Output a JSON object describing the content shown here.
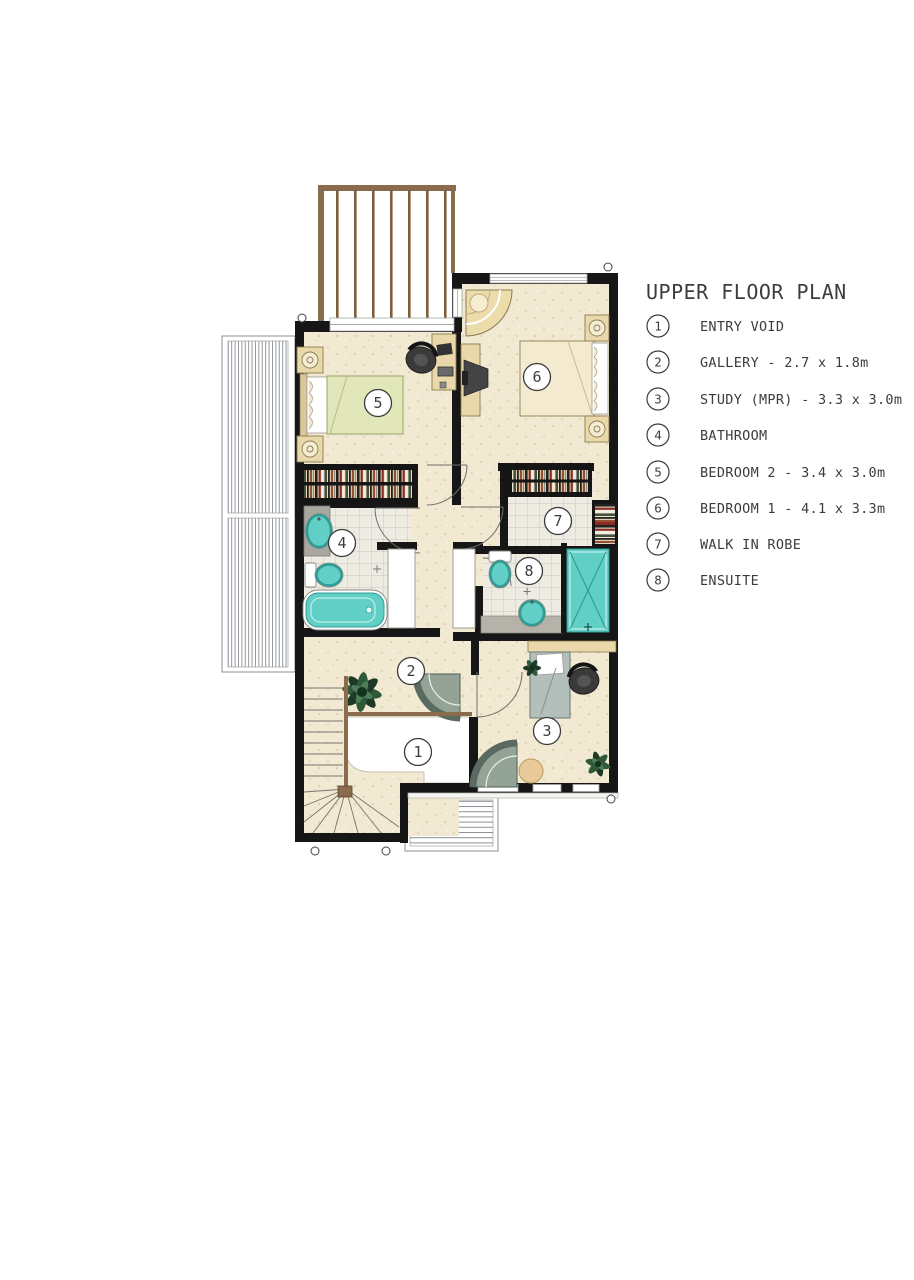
{
  "title": "UPPER FLOOR PLAN",
  "legend": {
    "items": [
      {
        "number": "1",
        "label": "ENTRY VOID"
      },
      {
        "number": "2",
        "label": "GALLERY - 2.7 x 1.8m"
      },
      {
        "number": "3",
        "label": "STUDY (MPR) - 3.3 x 3.0m"
      },
      {
        "number": "4",
        "label": "BATHROOM"
      },
      {
        "number": "5",
        "label": "BEDROOM 2 - 3.4 x 3.0m"
      },
      {
        "number": "6",
        "label": "BEDROOM 1 - 4.1 x 3.3m"
      },
      {
        "number": "7",
        "label": "WALK IN ROBE"
      },
      {
        "number": "8",
        "label": "ENSUITE"
      }
    ]
  },
  "colors": {
    "wall": "#161616",
    "floor": "#f1e9d1",
    "floorDot": "#ddd0ab",
    "tile": "#edebe2",
    "tileLine": "#c9c5b8",
    "teal": "#62cfc6",
    "tealDark": "#2f9d95",
    "tan": "#e9d8aa",
    "tanDark": "#8a7a50",
    "green": "#e2e7ba",
    "greenDark": "#9aa06a",
    "wood": "#8a6b4e",
    "lineGray": "#8a9094",
    "desk": "#b3bfba",
    "counter": "#b5b3a9",
    "vanity": "#a9a8a0",
    "chair": "#93a396",
    "chairDark": "#5a6a61",
    "plant": "#2e5a3a",
    "plantDark": "#1c3a26",
    "text": "#3c3c3c"
  }
}
